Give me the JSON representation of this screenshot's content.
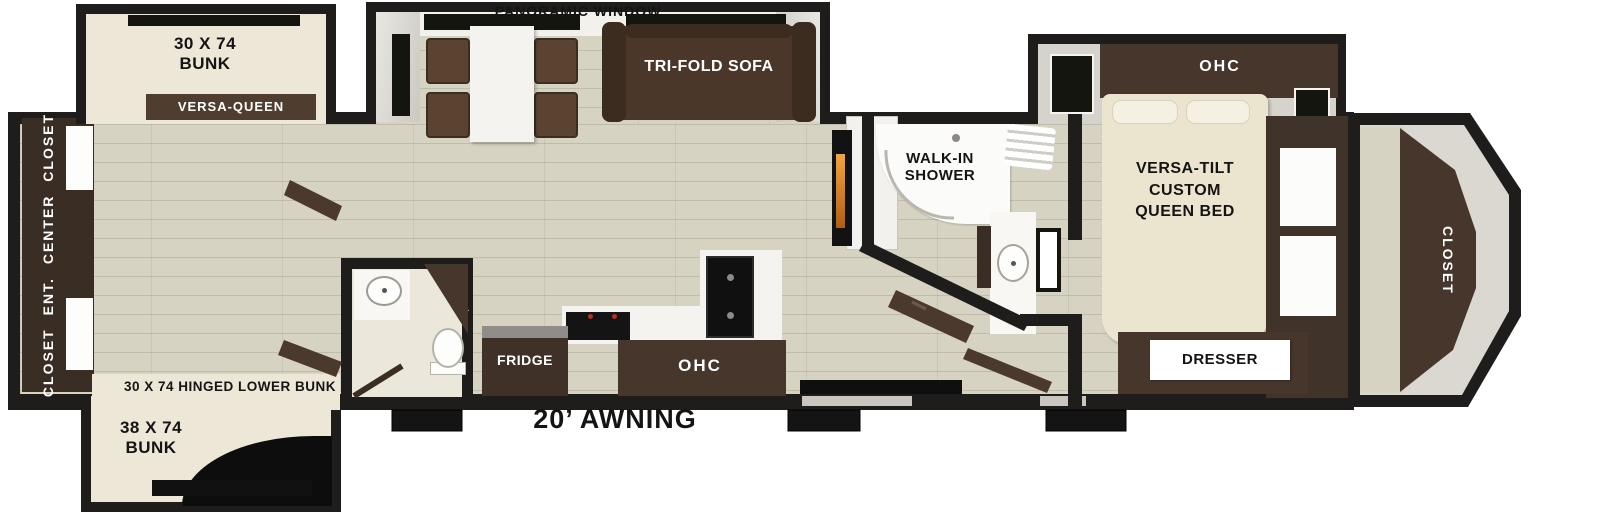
{
  "title": "Fifth-wheel RV floor plan",
  "colors": {
    "wall": "#1e1d1b",
    "floor_wood": "#d7d3c3",
    "cream_bed": "#ece7d6",
    "cabinet_brown": "#46362b",
    "sofa_brown": "#4a3729",
    "fireplace_orange": "#ef9533",
    "label_bar_white": "#ffffff"
  },
  "labels": {
    "panoramic_window": "PANORAMIC WINDOW",
    "bunk_top": "30 X 74\nBUNK",
    "versa_queen": "VERSA-QUEEN",
    "rear_storage": "CLOSET  ENT. CENTER  CLOSET",
    "tri_fold_sofa": "TRI-FOLD SOFA",
    "walk_in_shower": "WALK-IN\nSHOWER",
    "bedroom_ohc": "OHC",
    "queen_bed": "VERSA-TILT\nCUSTOM\nQUEEN BED",
    "front_closet": "CLOSET",
    "pantry": "PANTRY",
    "fridge": "FRIDGE",
    "kitchen_ohc": "OHC",
    "dresser": "DRESSER",
    "hinged_lower_bunk": "30 X 74 HINGED LOWER BUNK",
    "bunk_bottom": "38 X 74\nBUNK",
    "awning": "20’ AWNING"
  }
}
